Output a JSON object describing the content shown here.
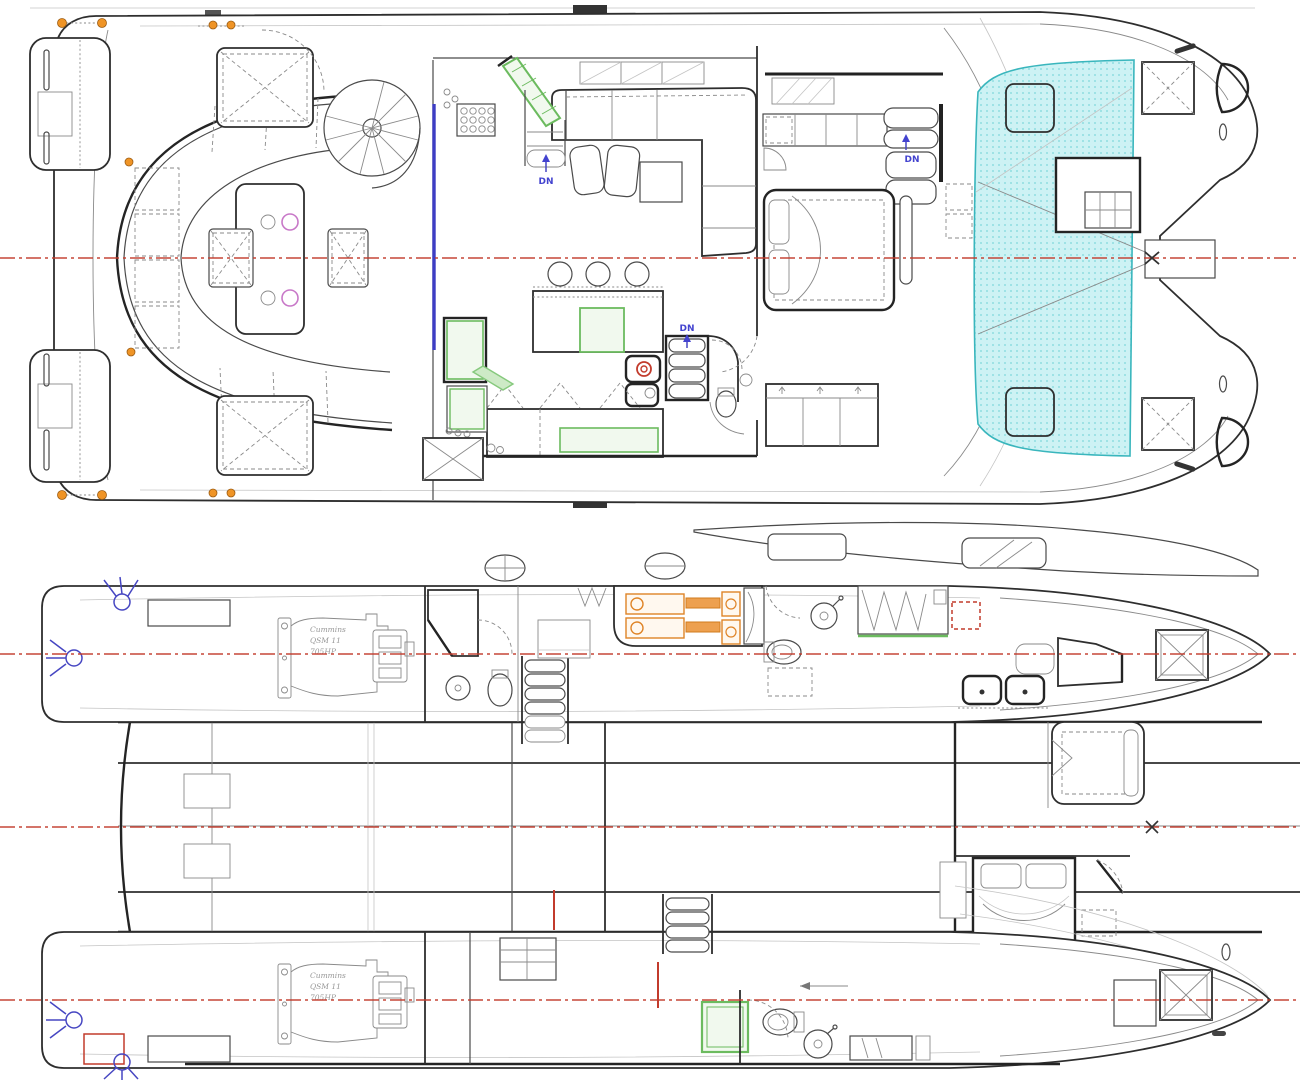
{
  "page": {
    "description": "Catamaran motor yacht general arrangement drawing, two deck plans (main deck above, lower deck / hulls below)"
  },
  "views": {
    "main_deck": {
      "name": "Main deck plan"
    },
    "lower_deck": {
      "name": "Lower deck plan"
    }
  },
  "labels": {
    "down": "DN"
  },
  "engine": {
    "make": "Cummins",
    "model": "QSM 11",
    "power": "705HP"
  },
  "colors": {
    "centerline_red": "#c23b2c",
    "trampoline_fill": "#cdf2f4",
    "trampoline_dot": "#8fdde0",
    "trampoline_edge": "#3ab6bd",
    "highlight_green": "#6cbb5f",
    "highlight_green_fill": "#f1f9ee",
    "highlight_orange": "#df8427",
    "divider_blue": "#3d3dc4",
    "label_blue": "#4343cf",
    "magenta": "#c878c8",
    "orange_dot": "#ef9426",
    "line_dark": "#2e2e2e",
    "line_gray": "#8a8a8a"
  }
}
